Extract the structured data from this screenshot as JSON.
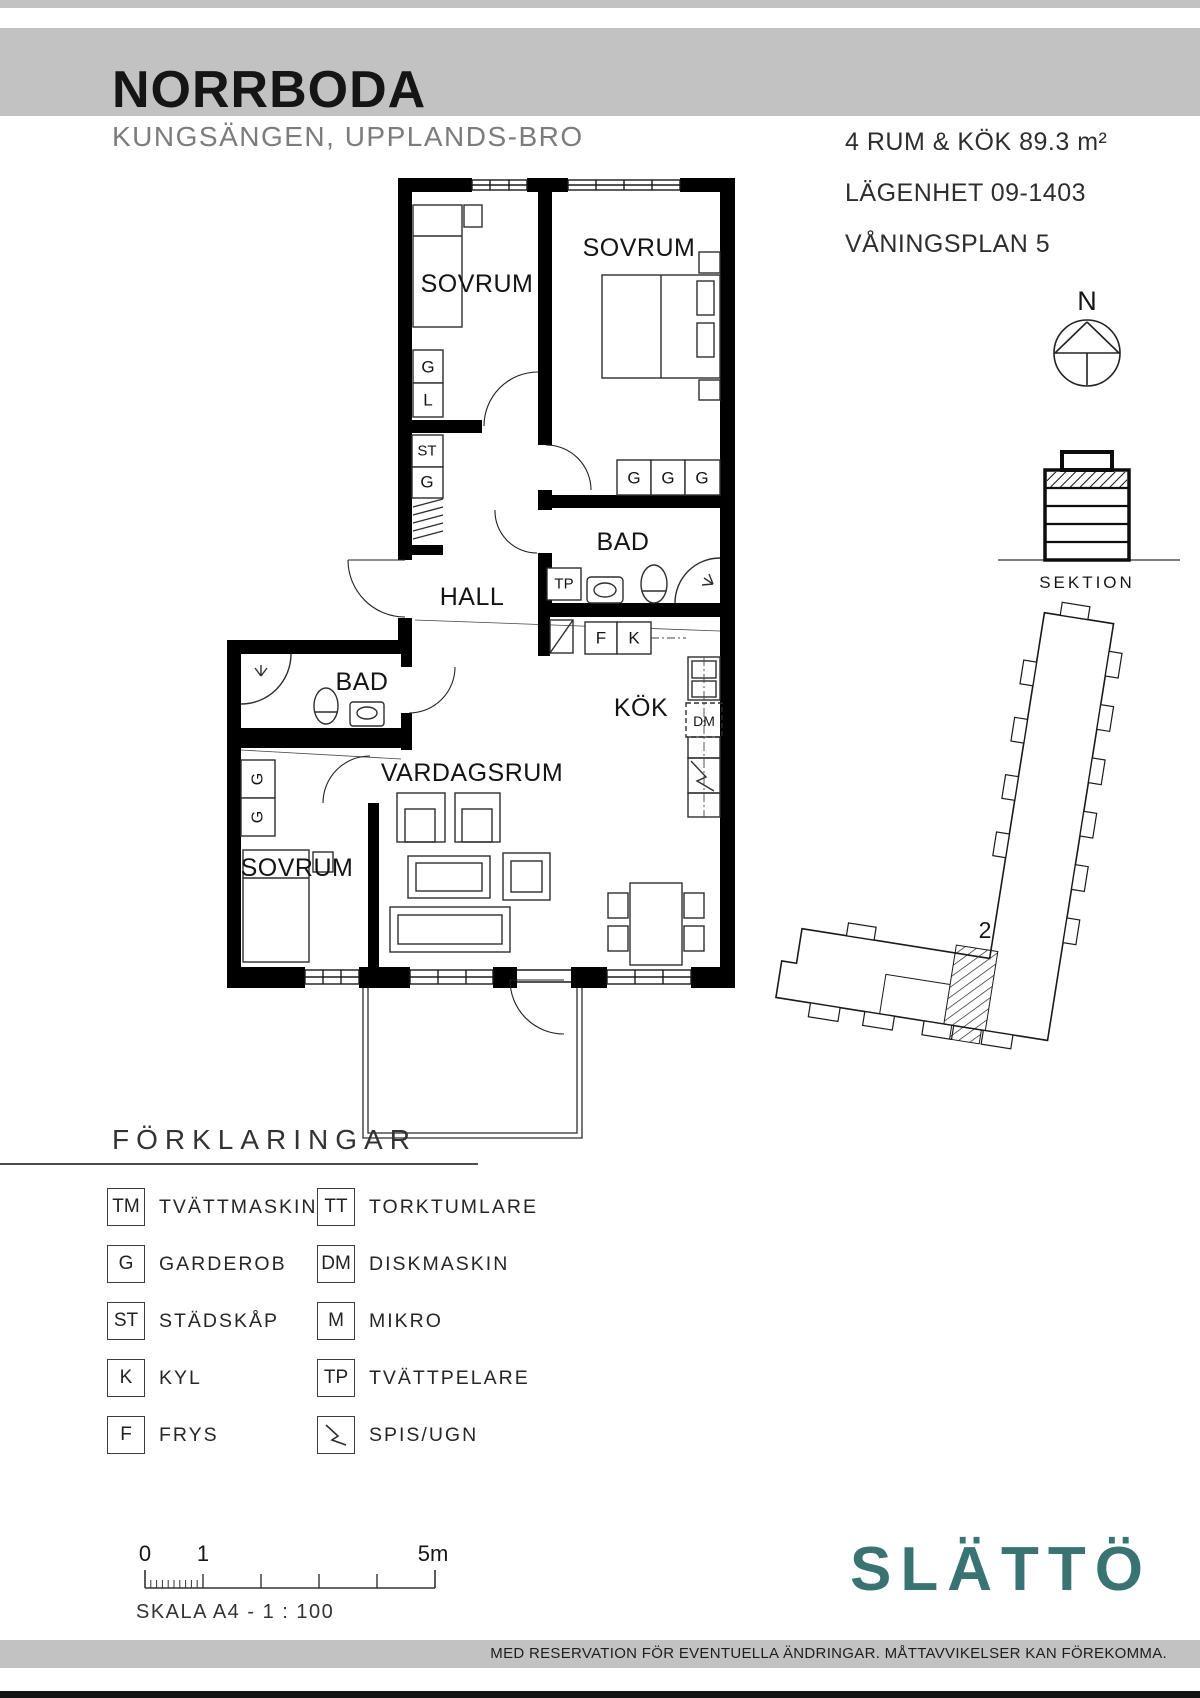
{
  "header": {
    "title": "NORRBODA",
    "subtitle": "KUNGSÄNGEN, UPPLANDS-BRO",
    "info_lines": [
      "4 RUM & KÖK 89.3 m²",
      "LÄGENHET 09-1403",
      "VÅNINGSPLAN 5"
    ]
  },
  "compass": {
    "north_label": "N"
  },
  "section": {
    "label": "SEKTION"
  },
  "floorplan": {
    "labels": {
      "sovrum": "SOVRUM",
      "bad": "BAD",
      "hall": "HALL",
      "kok": "KÖK",
      "vardagsrum": "VARDAGSRUM"
    },
    "markers": {
      "g": "G",
      "l": "L",
      "st": "ST",
      "tp": "TP",
      "f": "F",
      "k": "K",
      "dm": "DM"
    }
  },
  "siteplan": {
    "unit_number": "2"
  },
  "legend": {
    "heading": "FÖRKLARINGAR",
    "left": [
      {
        "code": "TM",
        "label": "TVÄTTMASKIN"
      },
      {
        "code": "G",
        "label": "GARDEROB"
      },
      {
        "code": "ST",
        "label": "STÄDSKÅP"
      },
      {
        "code": "K",
        "label": "KYL"
      },
      {
        "code": "F",
        "label": "FRYS"
      }
    ],
    "right": [
      {
        "code": "TT",
        "label": "TORKTUMLARE"
      },
      {
        "code": "DM",
        "label": "DISKMASKIN"
      },
      {
        "code": "M",
        "label": "MIKRO"
      },
      {
        "code": "TP",
        "label": "TVÄTTPELARE"
      },
      {
        "code": "",
        "label": "SPIS/UGN"
      }
    ]
  },
  "scalebar": {
    "t0": "0",
    "t1": "1",
    "t5": "5m",
    "scale_text": "SKALA A4 - 1 : 100"
  },
  "footer": {
    "brand": "SLÄTTÖ",
    "disclaimer": "MED RESERVATION FÖR EVENTUELLA ÄNDRINGAR. MÅTTAVVIKELSER KAN FÖREKOMMA."
  },
  "colors": {
    "band_gray": "#c2c2c2",
    "brand_teal": "#397473"
  }
}
